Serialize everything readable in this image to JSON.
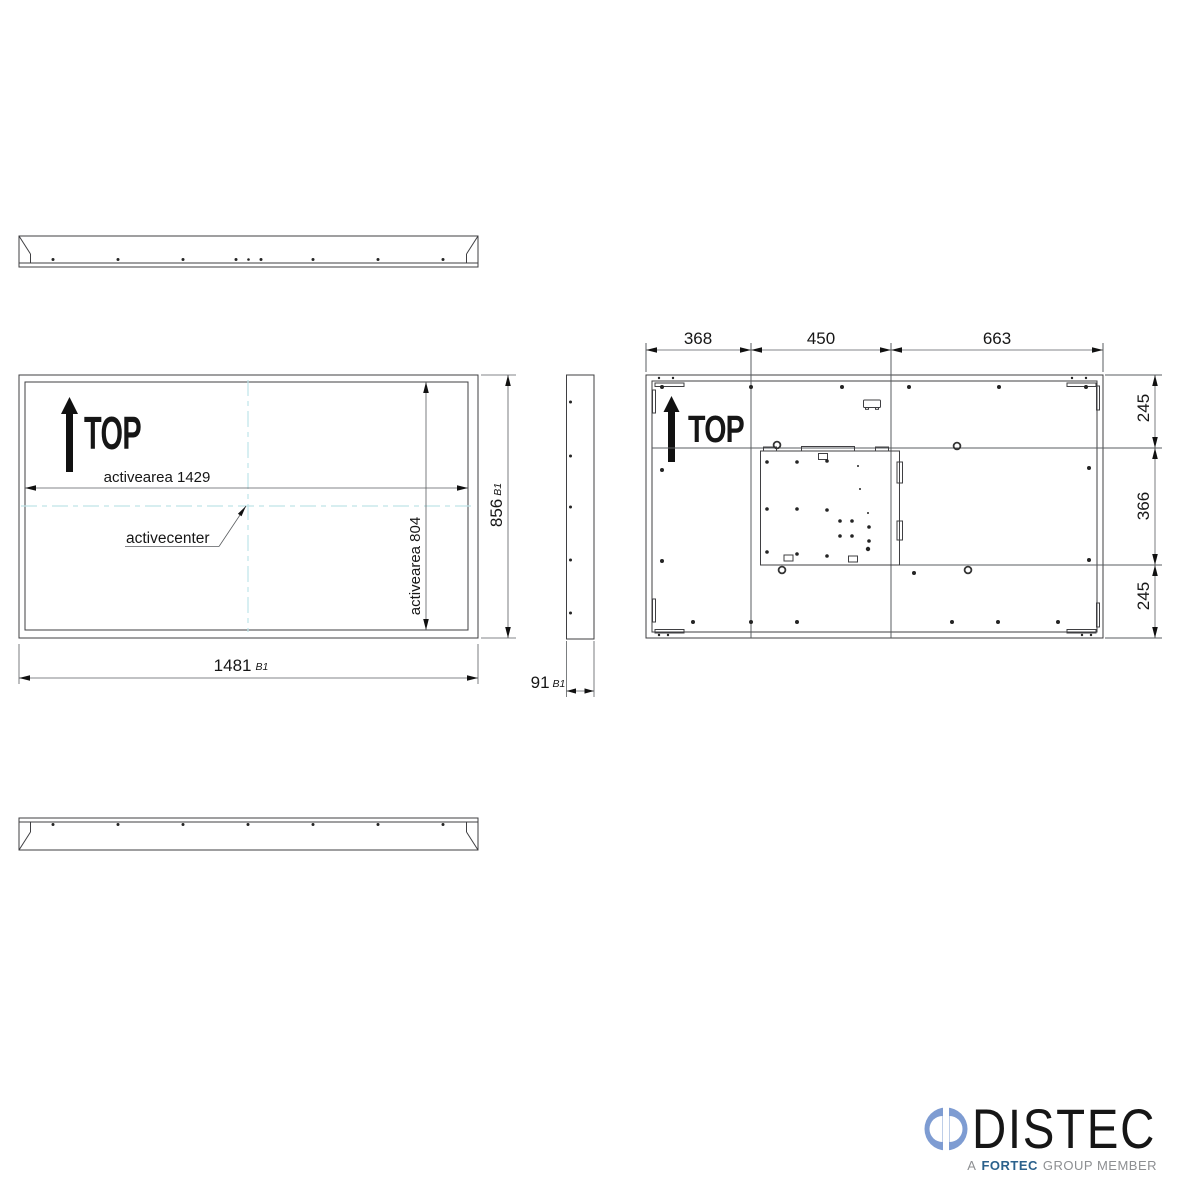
{
  "drawing": {
    "background": "#ffffff",
    "line_color": "#3f3f42",
    "centerline_color": "#bfe4e8",
    "front_view": {
      "orientation_label": "TOP",
      "active_width_label": "activearea 1429",
      "active_center_label": "activecenter",
      "active_height_label": "activearea 804",
      "height_dim": {
        "value": "856",
        "tolerance": "B1"
      },
      "width_dim": {
        "value": "1481",
        "tolerance": "B1"
      }
    },
    "side_view": {
      "depth_dim": {
        "value": "91",
        "tolerance": "B1"
      }
    },
    "rear_view": {
      "orientation_label": "TOP",
      "top_dims": [
        "368",
        "450",
        "663"
      ],
      "right_dims": [
        "245",
        "366",
        "245"
      ]
    }
  },
  "logo": {
    "brand": "DISTEC",
    "tagline": {
      "prefix": "A",
      "group": "FORTEC",
      "suffix": "GROUP MEMBER"
    },
    "colors": {
      "brand_text": "#55565b",
      "mark_blue": "#7e9cd2",
      "fortec_blue": "#2b618c",
      "tagline_gray": "#8d8f92"
    }
  }
}
